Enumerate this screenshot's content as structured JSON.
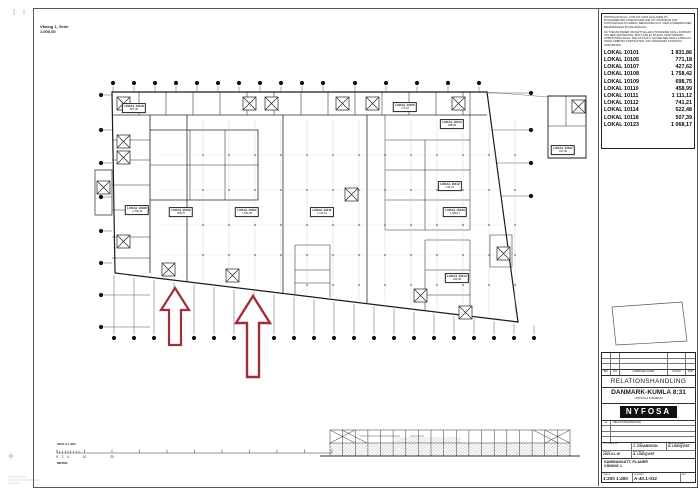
{
  "sheet": {
    "corner_note": {
      "line1": "Våning 1, Grön",
      "line2": "1.000,00"
    },
    "disclaimer_1": "RITNINGAR SKALL, FÖR ATT VARA GÄLLANDE PÅ BYGGARBETSPLATSEN ELLER FÖR ATT ANVÄNDAS FÖR KOSTNADSKALKYLERING, BERÄKNING M.M. VARA FÖRSEDDA MED BENÄMNINGEN BYGGHANDLING.",
    "disclaimer_2": "DÅ TVEKAN RÅDER OM MÅTT ELLER UTFÖRANDE SKALL KONTAKT TAS MED ARKITEKTEN. MÅTT FÅR EJ SKALAS UR RITNINGEN. UPPMÄTNING SKALL SKE PÅ PLATS. AVVIKELSER SKALL ANMÄLAS INNAN ARBETET FORTSÄTTER. VID OSÄKERHET KONTAKTA ARKITEKTEN.",
    "lokal_table": {
      "rows": [
        {
          "name": "LOKAL 10101",
          "area": "1 831,86"
        },
        {
          "name": "LOKAL 10105",
          "area": "771,18"
        },
        {
          "name": "LOKAL 10107",
          "area": "427,62"
        },
        {
          "name": "LOKAL 10108",
          "area": "1 758,42"
        },
        {
          "name": "LOKAL 10109",
          "area": "698,75"
        },
        {
          "name": "LOKAL 10110",
          "area": "458,99"
        },
        {
          "name": "LOKAL 10111",
          "area": "1 111,12"
        },
        {
          "name": "LOKAL 10112",
          "area": "741,21"
        },
        {
          "name": "LOKAL 10114",
          "area": "522,48"
        },
        {
          "name": "LOKAL 10118",
          "area": "507,39"
        },
        {
          "name": "LOKAL 10123",
          "area": "1 068,17"
        }
      ]
    },
    "plan": {
      "rooms": [
        {
          "name": "LOKAL 10118",
          "area": "507,39",
          "x": 134,
          "y": 108
        },
        {
          "name": "LOKAL 10105",
          "area": "771,18",
          "x": 405,
          "y": 107
        },
        {
          "name": "LOKAL 10110",
          "area": "458,99",
          "x": 452,
          "y": 124
        },
        {
          "name": "LOKAL 10107",
          "area": "427,62",
          "x": 563,
          "y": 150
        },
        {
          "name": "LOKAL 10112",
          "area": "741,21",
          "x": 450,
          "y": 186
        },
        {
          "name": "LOKAL 10108",
          "area": "1 758,42",
          "x": 137,
          "y": 210
        },
        {
          "name": "LOKAL 10109",
          "area": "698,75",
          "x": 181,
          "y": 212
        },
        {
          "name": "LOKAL 10101",
          "area": "1 831,86",
          "x": 247,
          "y": 212
        },
        {
          "name": "LOKAL 10111",
          "area": "1 111,12",
          "x": 322,
          "y": 212
        },
        {
          "name": "LOKAL 10123",
          "area": "1 068,17",
          "x": 455,
          "y": 212
        },
        {
          "name": "LOKAL 10114",
          "area": "522,48",
          "x": 457,
          "y": 278
        }
      ]
    },
    "scale_bar": {
      "label": "SKALA 1:200",
      "numbers": [
        "0",
        "2",
        "4",
        "10",
        "20"
      ],
      "unit": "METER"
    },
    "title_block": {
      "rev_cols": [
        "BET",
        "ANT",
        "ÄNDRINGEN AVSER",
        "DATUM",
        "SIGN"
      ],
      "status": "RELATIONSHANDLING",
      "project": "DANMARK-KUMLA 8:31",
      "municipality": "UPPSALA KOMMUN",
      "logo": "NYFOSA",
      "rev_row": {
        "bet": "A",
        "desc": "RELATIONSHANDLING"
      },
      "fields": {
        "uppdrag_label": "UPPDRAG NR",
        "uppdrag": "",
        "ritad_label": "RITAD AV",
        "ritad": "J. JOHANSSON",
        "handlaggare_label": "HANDLÄGGARE",
        "handlaggare": "Å. LINDQVIST",
        "datum_label": "DATUM",
        "datum": "2020-01-15",
        "ansvarig_label": "ANSVARIG",
        "ansvarig": "A. LINDQVIST"
      },
      "content_line1": "SAMMANSATT, PLANER",
      "content_line2": "VÅNING 1",
      "skala_label": "SKALA",
      "skala": "1:200   1:400",
      "nummer_label": "NUMMER",
      "nummer": "A-40.1-012",
      "bet_label": "BET"
    },
    "colors": {
      "arrow": "#9E2F38",
      "logo_bg": "#111111",
      "line": "#1a1a1a"
    }
  }
}
